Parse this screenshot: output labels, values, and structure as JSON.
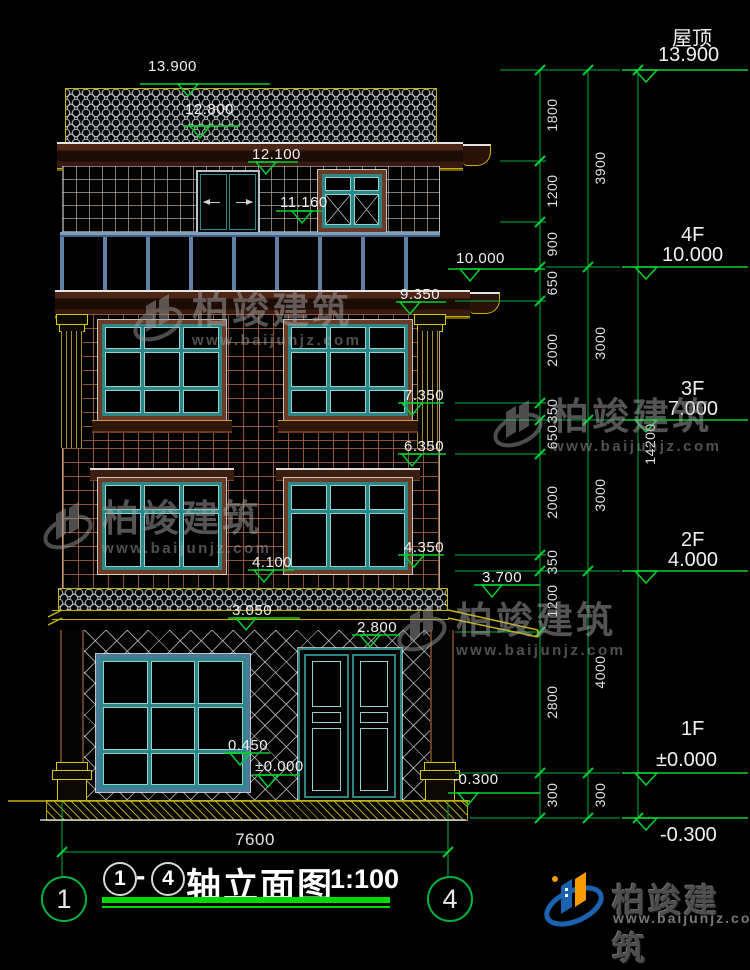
{
  "drawing": {
    "title_block": {
      "axis_start": "1",
      "separator": "-",
      "axis_end": "4",
      "title": "轴立面图",
      "scale": "1:100"
    },
    "grid_bubbles": {
      "left": "1",
      "right": "4"
    },
    "bottom_dimension": "7600"
  },
  "building_markers": [
    {
      "label": "13.900"
    },
    {
      "label": "12.800"
    },
    {
      "label": "12.100"
    },
    {
      "label": "11.160"
    },
    {
      "label": "10.000"
    },
    {
      "label": "9.350"
    },
    {
      "label": "7.350"
    },
    {
      "label": "6.350"
    },
    {
      "label": "4.350"
    },
    {
      "label": "4.100"
    },
    {
      "label": "3.700"
    },
    {
      "label": "3.050"
    },
    {
      "label": "2.800"
    },
    {
      "label": "0.450"
    },
    {
      "label": "±0.000"
    },
    {
      "label": "-0.300"
    }
  ],
  "dim_chains": {
    "inner": [
      "1800",
      "1200",
      "900",
      "650",
      "2000",
      "350",
      "650",
      "2000",
      "350",
      "1200",
      "2800",
      "300"
    ],
    "outer": [
      "3900",
      "3000",
      "3000",
      "4000",
      "300"
    ],
    "total": "14200"
  },
  "floor_levels": [
    {
      "name": "屋顶",
      "elevation": "13.900"
    },
    {
      "name": "4F",
      "elevation": "10.000"
    },
    {
      "name": "3F",
      "elevation": "7.000"
    },
    {
      "name": "2F",
      "elevation": "4.000"
    },
    {
      "name": "1F",
      "elevation": "±0.000"
    },
    {
      "name": "",
      "elevation": "-0.300"
    }
  ],
  "watermark": {
    "brand": "柏竣建筑",
    "url": "www.baijunjz.com"
  },
  "logo": {
    "brand": "柏竣建筑",
    "url": "www.baijunjz.com"
  },
  "colors": {
    "dim_green": "#00b140",
    "trim_yellow": "#c8b400",
    "frame_teal": "#2d8686",
    "wall_brown": "#9b5f3c",
    "accent_blue": "#1a63b0",
    "accent_orange": "#f59a00"
  }
}
